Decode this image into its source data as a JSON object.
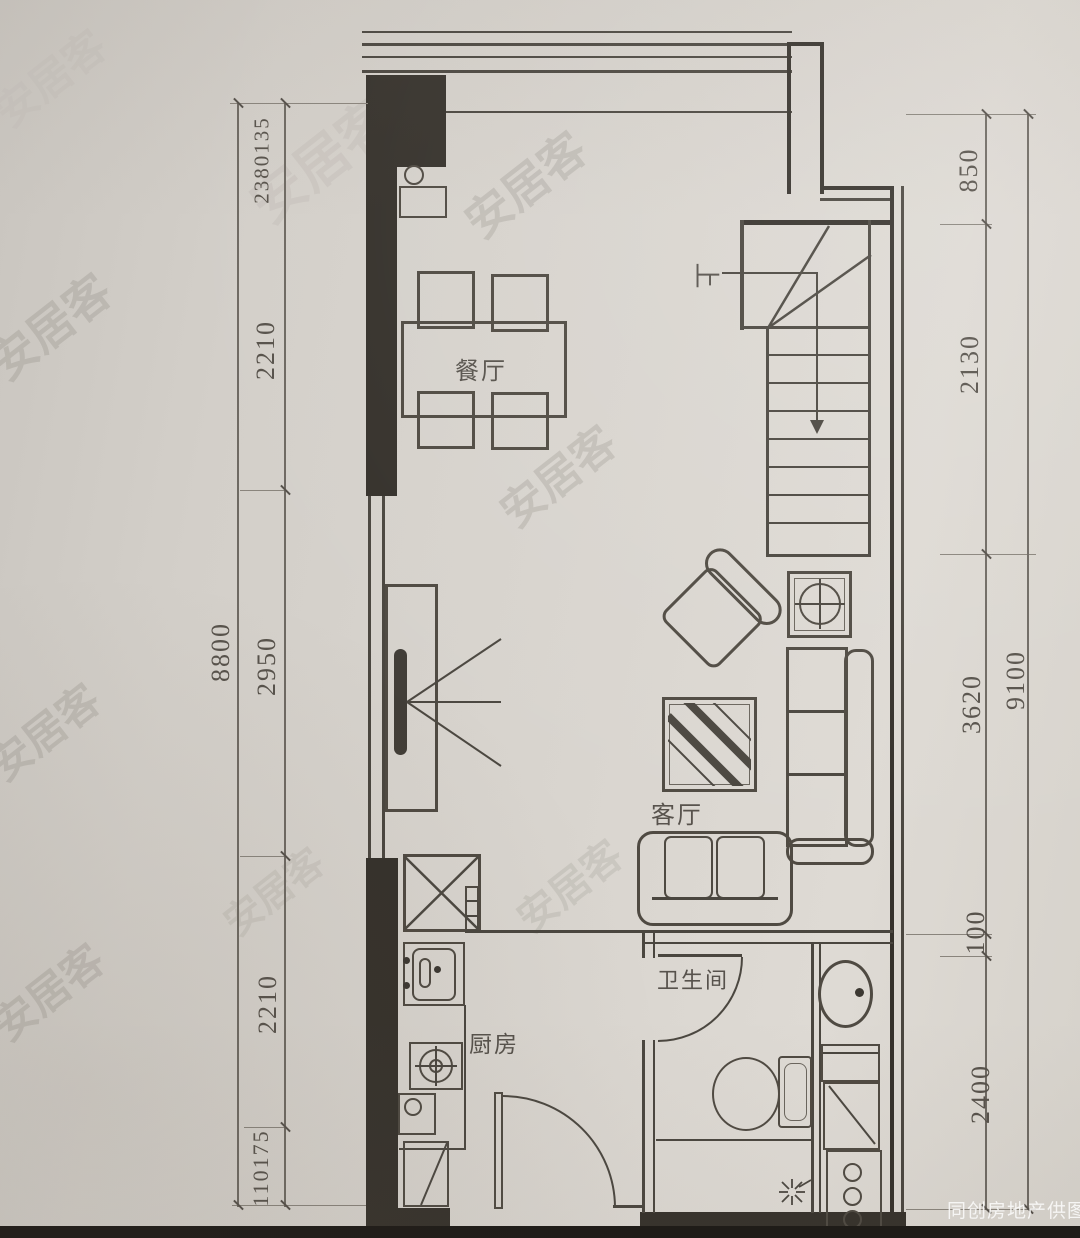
{
  "watermark": {
    "brand": "安居客",
    "credit": "同创房地产供图"
  },
  "rooms": {
    "dining": "餐厅",
    "living": "客厅",
    "kitchen": "厨房",
    "bathroom": "卫生间"
  },
  "stairs": {
    "up_label": "上"
  },
  "dimensions": {
    "left_outer": "8800",
    "left_inner": [
      "2380135",
      "2210",
      "2950",
      "2210",
      "110175"
    ],
    "right_inner": [
      "850",
      "2130",
      "3620",
      "100",
      "2400"
    ],
    "right_outer": "9100"
  }
}
